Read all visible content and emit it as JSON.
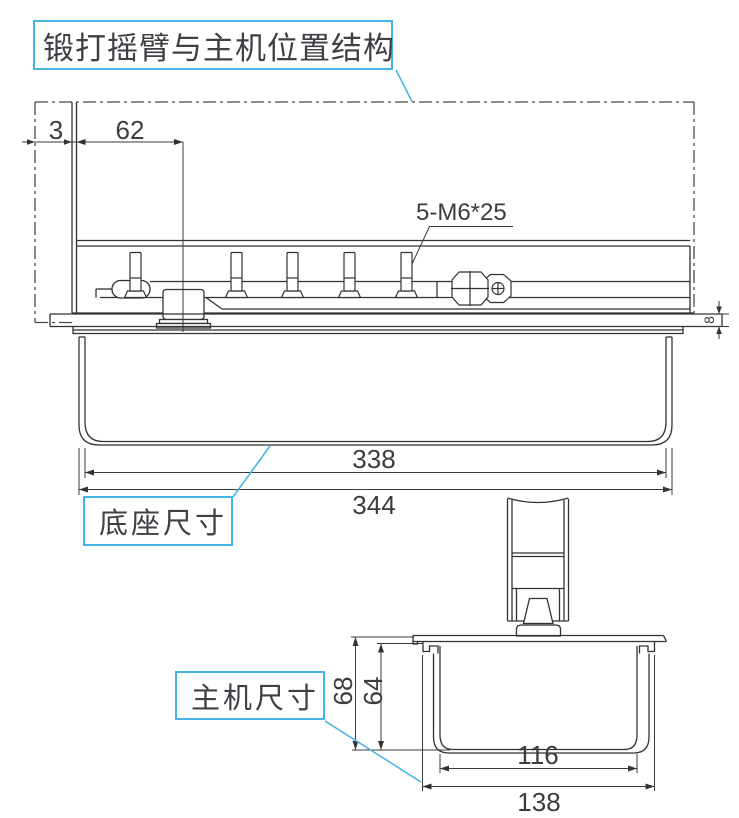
{
  "title": {
    "text": "锻打摇臂与主机位置结构"
  },
  "labels": {
    "base_size": "底座尺寸",
    "host_size": "主机尺寸"
  },
  "annotations": {
    "bolt_spec": "5-M6*25"
  },
  "dimensions": {
    "wall_thickness": "3",
    "arm_offset": "62",
    "plate_thickness": "8",
    "base_inner_width": "338",
    "base_outer_width": "344",
    "host_outer_height": "68",
    "host_inner_height": "64",
    "host_inner_width": "116",
    "host_outer_width": "138"
  },
  "colors": {
    "accent_blue": "#43b4e4",
    "line": "#323232",
    "text": "#3a3d40"
  }
}
